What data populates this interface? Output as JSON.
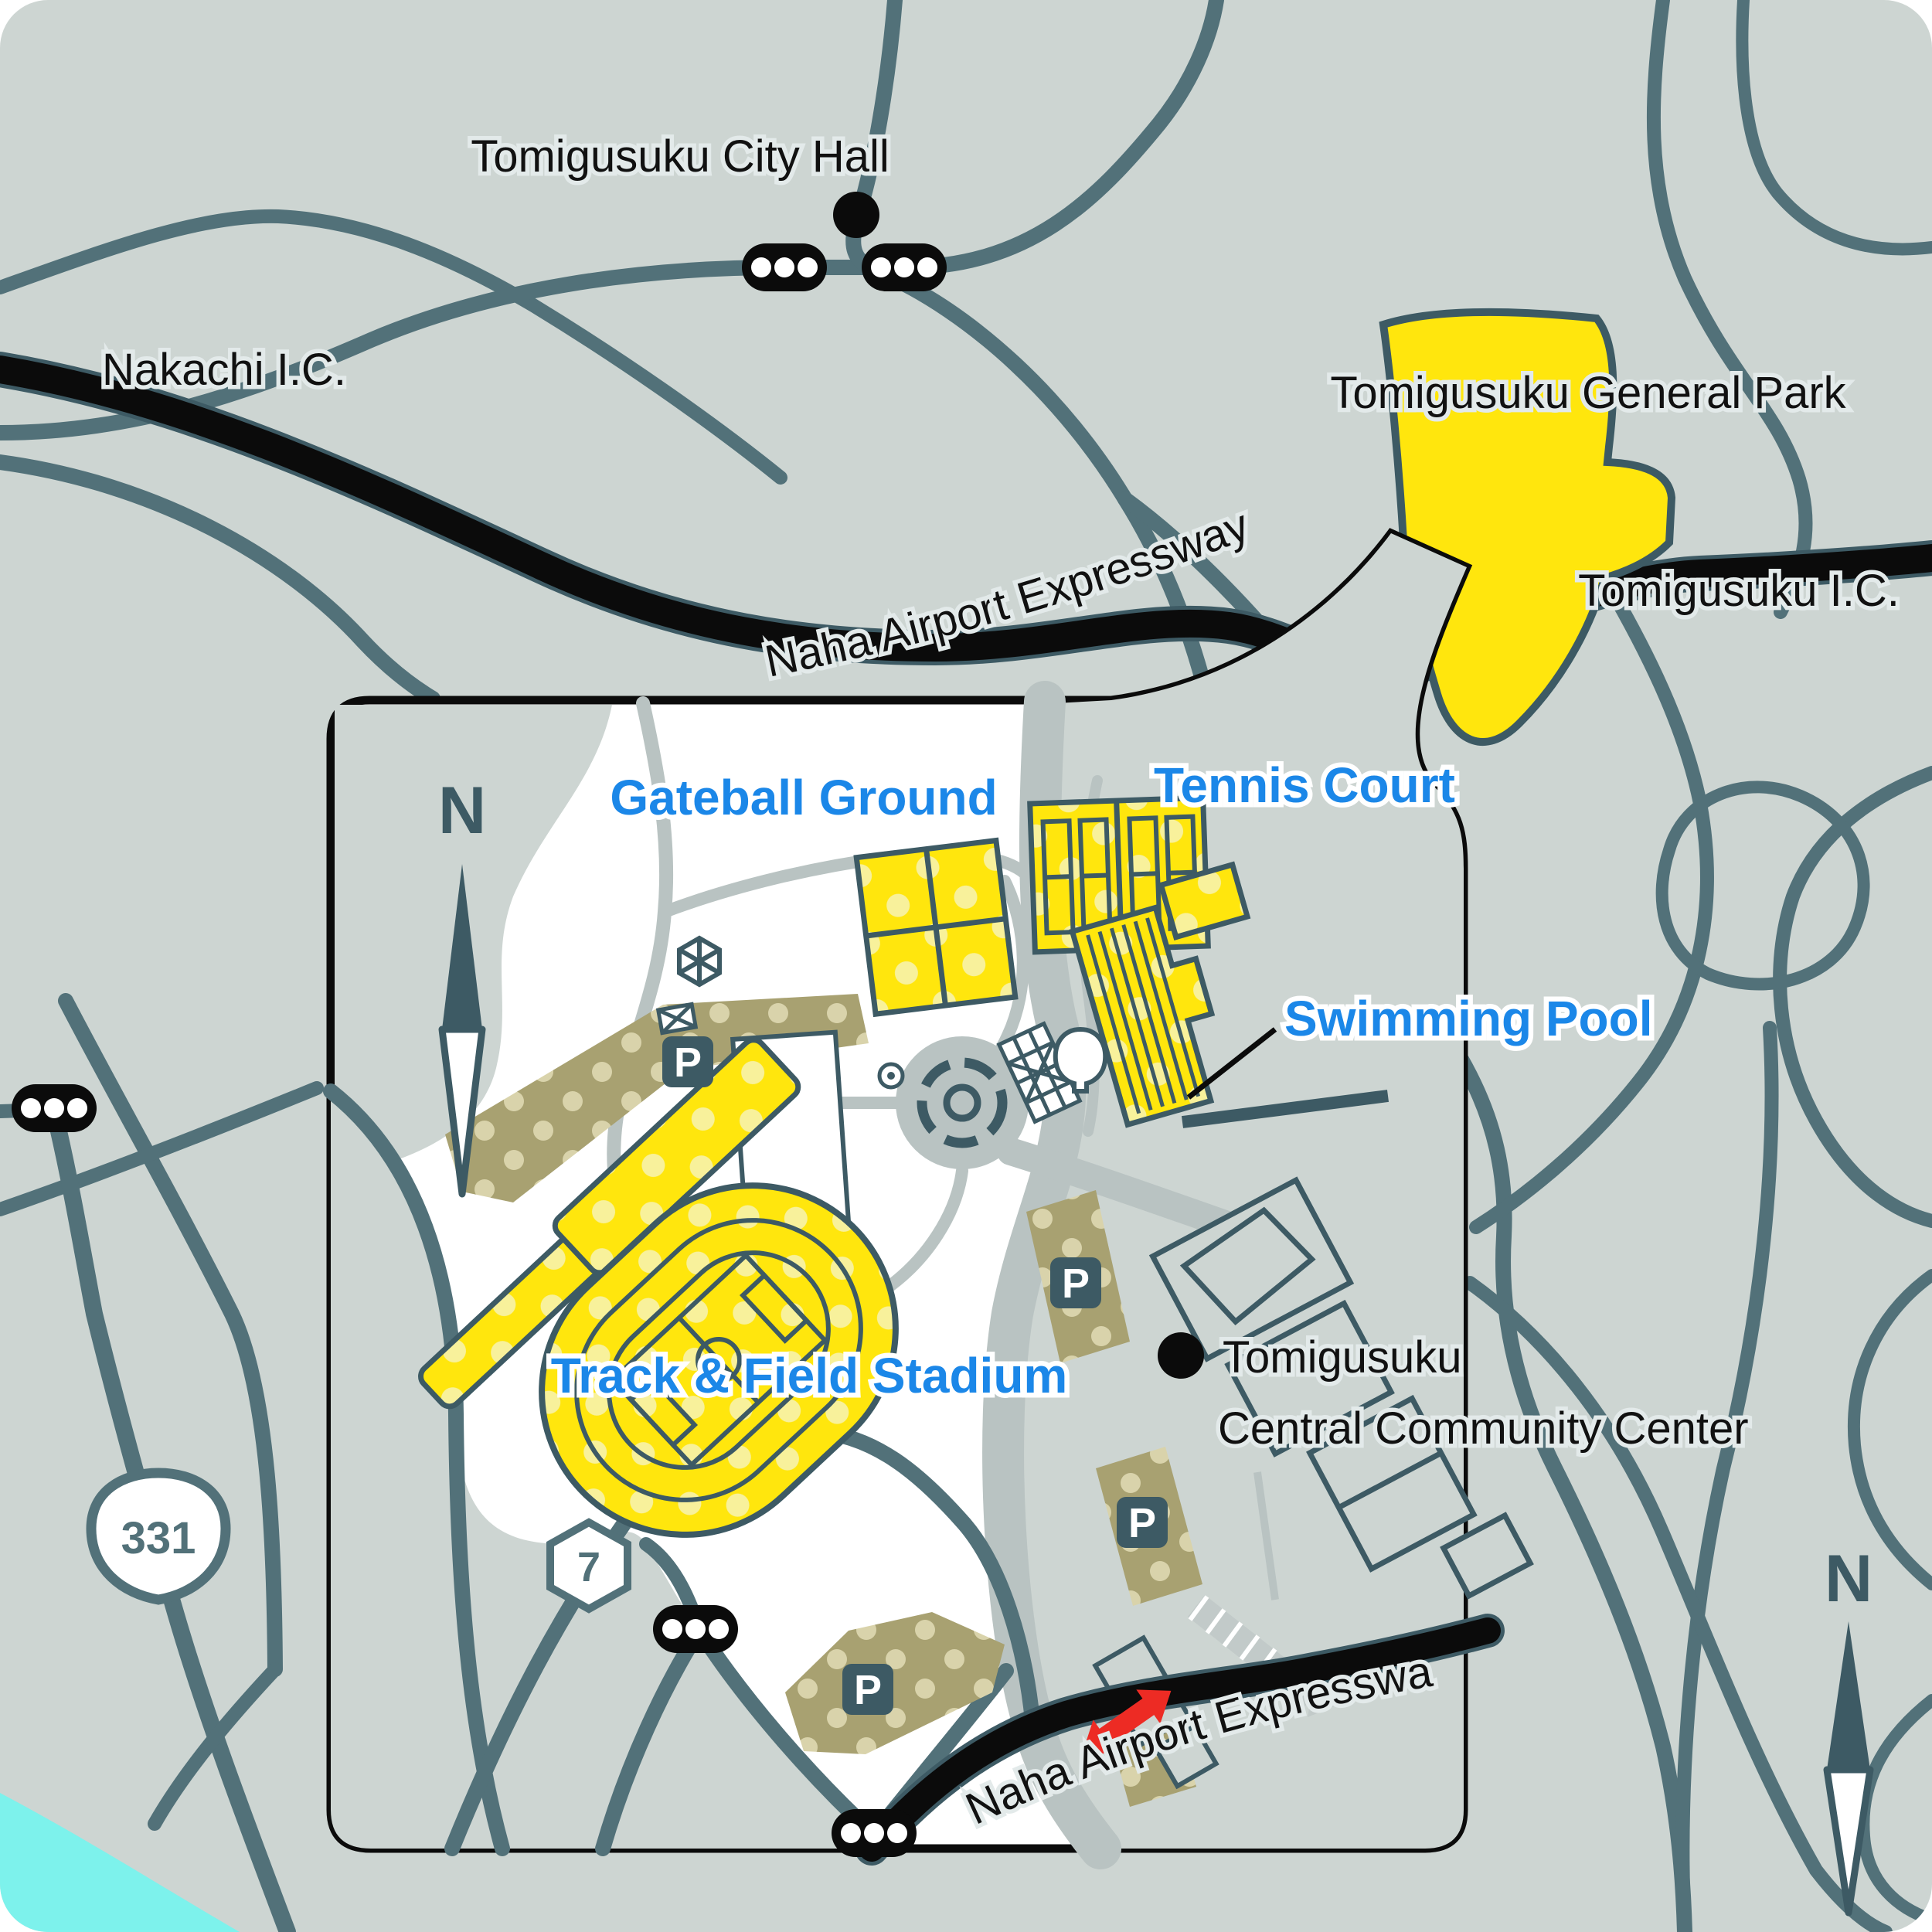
{
  "labels": {
    "city_hall": "Tomigusuku City Hall",
    "nakachi_ic": "Nakachi I.C.",
    "general_park": "Tomigusuku General Park",
    "tomigusuku_ic": "Tomigusuku I.C.",
    "expressway_top": "Naha Airport Expressway",
    "expressway_bottom": "Naha Airport Expressway",
    "community_center_line1": "Tomigusuku",
    "community_center_line2": "Central Community Center",
    "gateball": "Gateball Ground",
    "tennis": "Tennis Court",
    "pool": "Swimming Pool",
    "stadium": "Track & Field Stadium",
    "parking": "P",
    "north": "N",
    "route_331": "331",
    "route_7": "7"
  },
  "icons": [
    {
      "name": "traffic-signal-icon",
      "desc": "black pill with three white lamps",
      "count": 5
    },
    {
      "name": "parking-icon",
      "desc": "dark rounded square with white P",
      "count": 4
    },
    {
      "name": "north-compass-icon",
      "desc": "N above two-part needle",
      "count": 2
    },
    {
      "name": "poi-dot-icon",
      "desc": "black filled circle marking a building",
      "count": 2
    },
    {
      "name": "route-badge-331-icon",
      "desc": "white rounded-triangle national route shield"
    },
    {
      "name": "route-badge-7-icon",
      "desc": "white hexagon prefectural route shield"
    },
    {
      "name": "entrance-arrow-icon",
      "desc": "red double-headed arrow at park entrance"
    },
    {
      "name": "roundabout-icon",
      "desc": "segmented circular plaza"
    },
    {
      "name": "gazebo-icon",
      "desc": "hexagonal shelter"
    },
    {
      "name": "tree-icon",
      "desc": "round tree outline"
    },
    {
      "name": "footbridge-icon",
      "desc": "hatched pedestrian ramp"
    }
  ],
  "theme": {
    "background": "#cdd5d2",
    "road_teal": "#527179",
    "path_gray": "#b9c3c2",
    "expressway_black": "#0b0b0b",
    "facility_yellow": "#ffe60d",
    "facility_dot": "#f8f19b",
    "parking_khaki": "#a8a171",
    "parking_dot": "#d9d3ab",
    "outline_dark": "#3d5a64",
    "label_blue": "#1b87e8",
    "arrow_red": "#ed2b24",
    "sea_cyan": "#7df2ec",
    "park_white": "#ffffff"
  }
}
